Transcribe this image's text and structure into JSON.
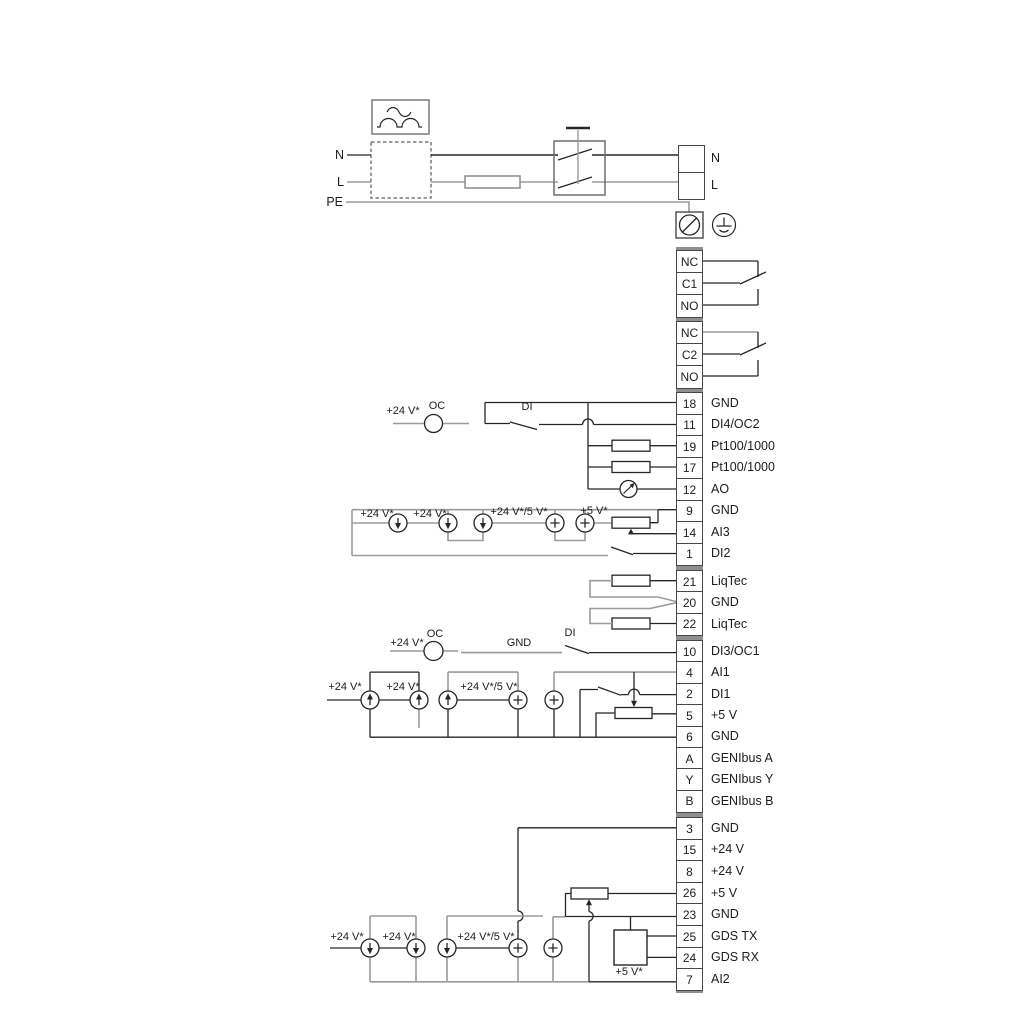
{
  "colors": {
    "wire_dark": "#262626",
    "wire_gray": "#9b9b9b",
    "terminal_border": "#474747",
    "group_cap": "#8f8f8f",
    "background": "#ffffff"
  },
  "symbols": [
    "ac-rectified-waveform-icon",
    "rectifier-dashed-box",
    "fuse-icon",
    "double-pole-mains-switch-icon",
    "pe-terminal-icon",
    "protective-earth-icon",
    "open-collector-circle-icon",
    "current-source-arrow-icon",
    "voltage-source-plus-icon",
    "potentiometer-icon",
    "resistor-icon",
    "analog-output-meter-icon",
    "gds-module-box"
  ],
  "power_labels": {
    "n_left": "N",
    "l_left": "L",
    "pe": "PE"
  },
  "terminal_groups": [
    {
      "id": "mains",
      "terminals": [
        {
          "num": "",
          "label": "N"
        },
        {
          "num": "",
          "label": "L"
        }
      ]
    },
    {
      "id": "relay1",
      "terminals": [
        {
          "num": "NC",
          "label": ""
        },
        {
          "num": "C1",
          "label": ""
        },
        {
          "num": "NO",
          "label": ""
        }
      ]
    },
    {
      "id": "relay2",
      "terminals": [
        {
          "num": "NC",
          "label": ""
        },
        {
          "num": "C2",
          "label": ""
        },
        {
          "num": "NO",
          "label": ""
        }
      ]
    },
    {
      "id": "io1",
      "terminals": [
        {
          "num": "18",
          "label": "GND"
        },
        {
          "num": "11",
          "label": "DI4/OC2"
        },
        {
          "num": "19",
          "label": "Pt100/1000"
        },
        {
          "num": "17",
          "label": "Pt100/1000"
        },
        {
          "num": "12",
          "label": "AO"
        },
        {
          "num": "9",
          "label": "GND"
        },
        {
          "num": "14",
          "label": "AI3"
        },
        {
          "num": "1",
          "label": "DI2"
        }
      ]
    },
    {
      "id": "liqtec",
      "terminals": [
        {
          "num": "21",
          "label": "LiqTec"
        },
        {
          "num": "20",
          "label": "GND"
        },
        {
          "num": "22",
          "label": "LiqTec"
        }
      ]
    },
    {
      "id": "io2",
      "terminals": [
        {
          "num": "10",
          "label": "DI3/OC1"
        },
        {
          "num": "4",
          "label": "AI1"
        },
        {
          "num": "2",
          "label": "DI1"
        },
        {
          "num": "5",
          "label": "+5 V"
        },
        {
          "num": "6",
          "label": "GND"
        },
        {
          "num": "A",
          "label": "GENIbus A"
        },
        {
          "num": "Y",
          "label": "GENIbus Y"
        },
        {
          "num": "B",
          "label": "GENIbus B"
        }
      ]
    },
    {
      "id": "io3",
      "terminals": [
        {
          "num": "3",
          "label": "GND"
        },
        {
          "num": "15",
          "label": "+24 V"
        },
        {
          "num": "8",
          "label": "+24 V"
        },
        {
          "num": "26",
          "label": "+5 V"
        },
        {
          "num": "23",
          "label": "GND"
        },
        {
          "num": "25",
          "label": "GDS TX"
        },
        {
          "num": "24",
          "label": "GDS RX"
        },
        {
          "num": "7",
          "label": "AI2"
        }
      ]
    }
  ],
  "wire_labels": [
    {
      "id": "pw-n",
      "text": "N"
    },
    {
      "id": "pw-l",
      "text": "L"
    },
    {
      "id": "pw-pe",
      "text": "PE"
    },
    {
      "id": "r11-v24",
      "text": "+24 V*"
    },
    {
      "id": "r11-oc",
      "text": "OC"
    },
    {
      "id": "r11-di",
      "text": "DI"
    },
    {
      "id": "sa-v24a",
      "text": "+24 V*"
    },
    {
      "id": "sa-v24b",
      "text": "+24 V*"
    },
    {
      "id": "sa-v245",
      "text": "+24 V*/5 V*"
    },
    {
      "id": "sa-v5",
      "text": "+5 V*"
    },
    {
      "id": "r10-v24",
      "text": "+24 V*"
    },
    {
      "id": "r10-oc",
      "text": "OC"
    },
    {
      "id": "r10-gnd",
      "text": "GND"
    },
    {
      "id": "r10-di",
      "text": "DI"
    },
    {
      "id": "sb-v24a",
      "text": "+24 V*"
    },
    {
      "id": "sb-v24b",
      "text": "+24 V*"
    },
    {
      "id": "sb-v245",
      "text": "+24 V*/5 V*"
    },
    {
      "id": "sc-v24a",
      "text": "+24 V*"
    },
    {
      "id": "sc-v24b",
      "text": "+24 V*"
    },
    {
      "id": "sc-v245",
      "text": "+24 V*/5 V*"
    },
    {
      "id": "sc-v5",
      "text": "+5 V*"
    }
  ]
}
